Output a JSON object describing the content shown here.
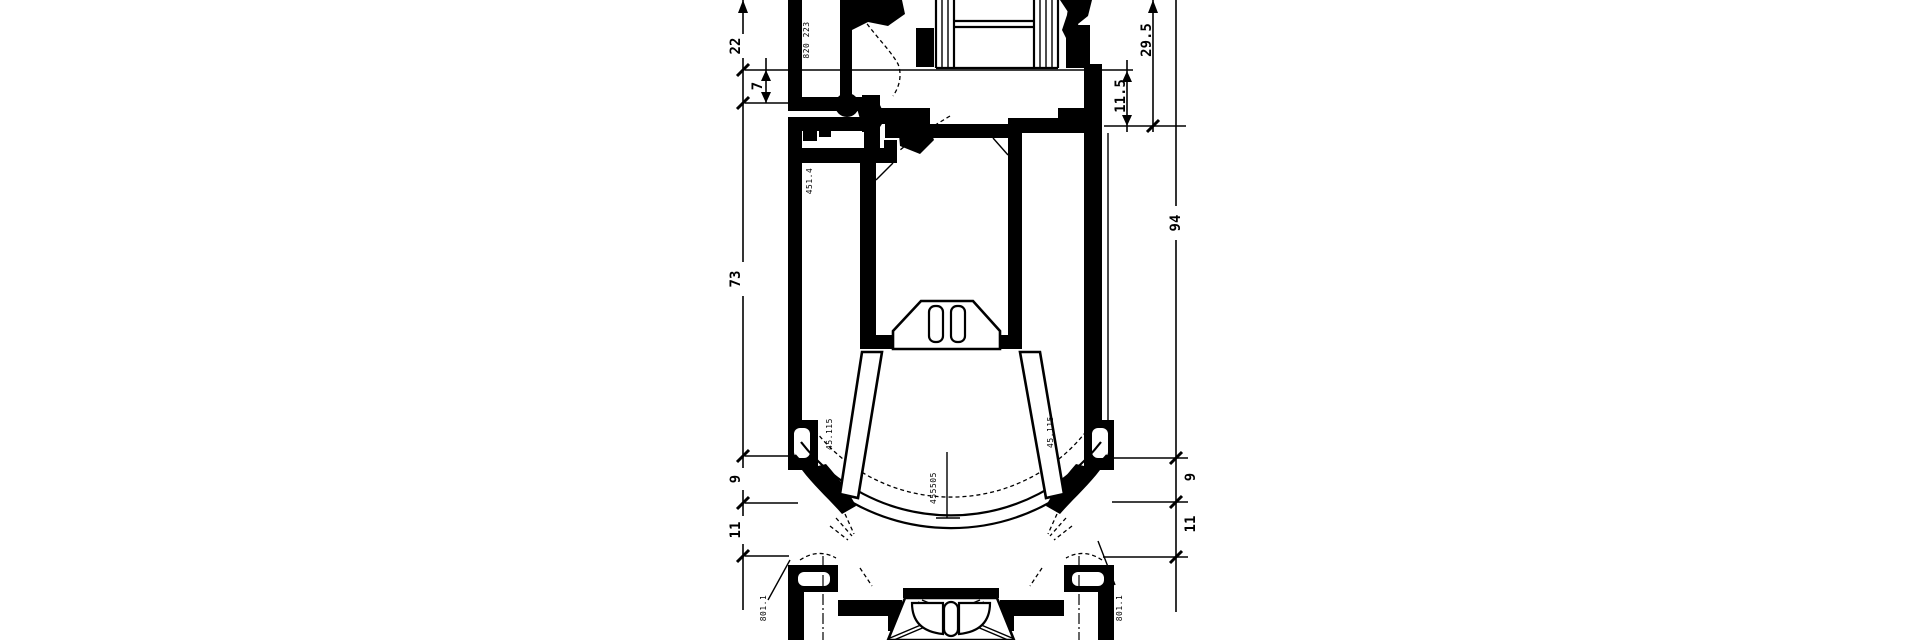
{
  "meta": {
    "type": "cad-profile-cross-section",
    "background_color": "#ffffff",
    "ink_color": "#000000"
  },
  "dimensions": {
    "left": [
      "22",
      "7",
      "73",
      "9",
      "11"
    ],
    "right": [
      "29.5",
      "11.5",
      "94",
      "9",
      "11"
    ]
  },
  "part_labels": {
    "sash_bead": "820 223",
    "frame_chamber": "451.4",
    "gasket_left": "45.115",
    "gasket_right": "45.115",
    "arc_assembly": "455505",
    "sill_left": "801.1",
    "sill_right": "801.1"
  }
}
